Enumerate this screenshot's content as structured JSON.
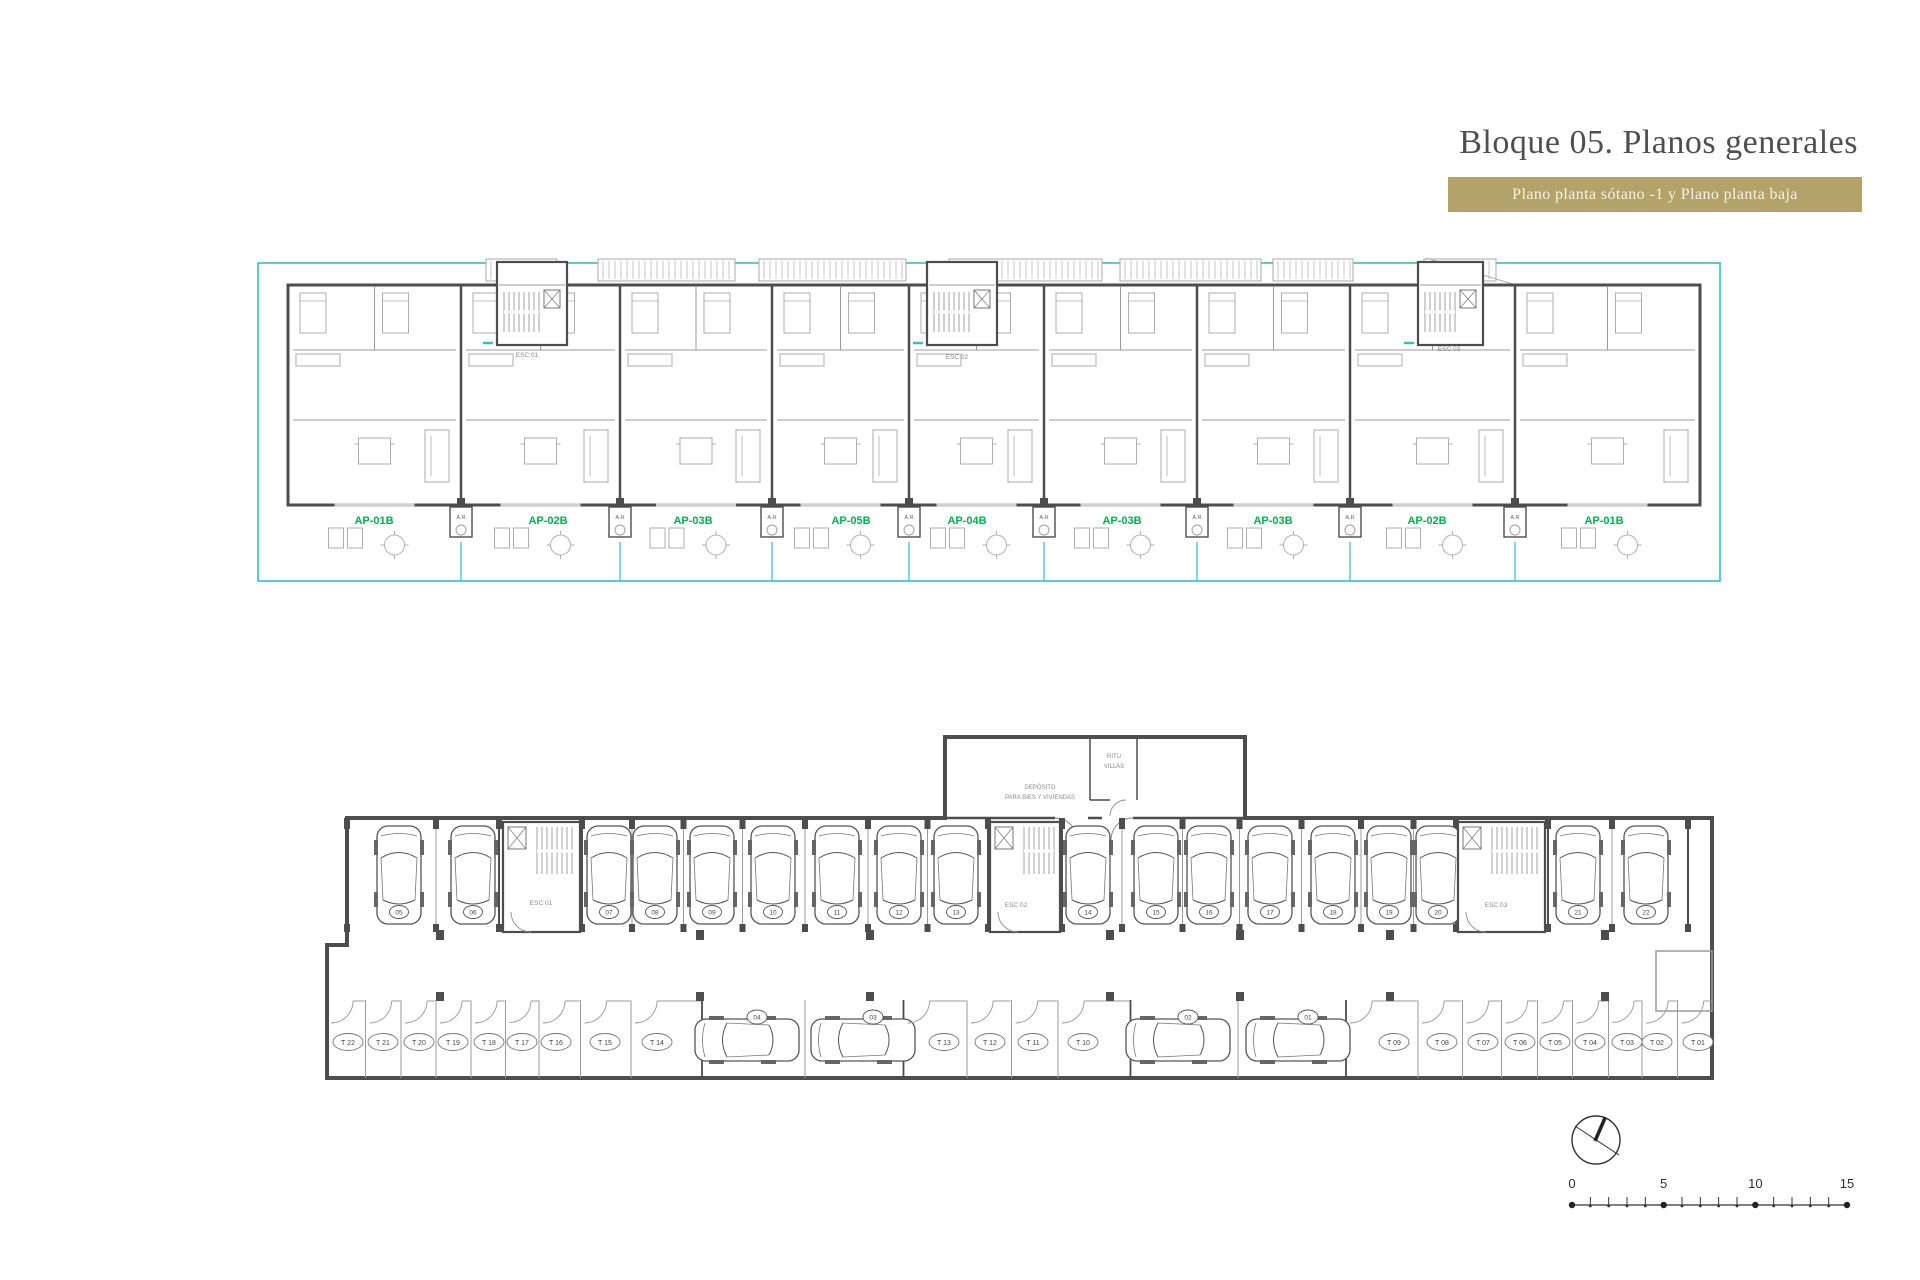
{
  "header": {
    "title": "Bloque 05. Planos generales",
    "subtitle": "Plano planta sótano -1 y Plano planta baja"
  },
  "colors": {
    "band": "#b3a369",
    "title_text": "#4f4f4f",
    "wall": "#4d4d4d",
    "light_wall": "#9b9b9b",
    "furniture": "#aeaeae",
    "boundary_cyan": "#2fc2c6",
    "unit_green": "#00b24f",
    "small_text": "#8a8a8a",
    "scale_text": "#2e2e2e"
  },
  "icons": {
    "compass": "north-arrow-icon"
  },
  "upper_plan": {
    "units": [
      {
        "label": "AP-01B",
        "x": 374
      },
      {
        "label": "AP-02B",
        "x": 548
      },
      {
        "label": "AP-03B",
        "x": 693
      },
      {
        "label": "AP-05B",
        "x": 851
      },
      {
        "label": "AP-04B",
        "x": 967
      },
      {
        "label": "AP-03B",
        "x": 1122
      },
      {
        "label": "AP-03B",
        "x": 1273
      },
      {
        "label": "AP-02B",
        "x": 1427
      },
      {
        "label": "AP-01B",
        "x": 1604
      }
    ],
    "stair_cores": [
      {
        "label": "ESC 01",
        "x1": 497,
        "x2": 567,
        "lx": 527,
        "ly": 357
      },
      {
        "label": "ESC 02",
        "x1": 927,
        "x2": 997,
        "lx": 957,
        "ly": 359
      },
      {
        "label": "ESC 03",
        "x1": 1418,
        "x2": 1483,
        "lx": 1449,
        "ly": 351
      }
    ],
    "utility_label": "A.R"
  },
  "lower_plan": {
    "rooms": [
      {
        "lines": [
          "DEPÓSITO",
          "PARA BIES Y VIVIENDAS"
        ],
        "x": 1040,
        "y": 789
      },
      {
        "lines": [
          "RITU",
          "VILLAS"
        ],
        "x": 1114,
        "y": 758
      }
    ],
    "stair_cores": [
      {
        "label": "ESC 01",
        "x1": 503,
        "x2": 580,
        "lx": 541,
        "ly": 905
      },
      {
        "label": "ESC 02",
        "x1": 990,
        "x2": 1060,
        "lx": 1016,
        "ly": 907
      },
      {
        "label": "ESC 03",
        "x1": 1458,
        "x2": 1545,
        "lx": 1496,
        "ly": 907
      }
    ],
    "top_row_groups": [
      {
        "x1": 347,
        "x2": 499,
        "cars": [
          {
            "num": "05",
            "x": 399
          },
          {
            "num": "06",
            "x": 473
          }
        ]
      },
      {
        "x1": 582,
        "x2": 988,
        "cars": [
          {
            "num": "07",
            "x": 609
          },
          {
            "num": "08",
            "x": 655
          },
          {
            "num": "09",
            "x": 712
          },
          {
            "num": "10",
            "x": 773
          },
          {
            "num": "11",
            "x": 837
          },
          {
            "num": "12",
            "x": 899
          },
          {
            "num": "13",
            "x": 956
          }
        ]
      },
      {
        "x1": 1062,
        "x2": 1456,
        "cars": [
          {
            "num": "14",
            "x": 1088
          },
          {
            "num": "15",
            "x": 1156
          },
          {
            "num": "16",
            "x": 1209
          },
          {
            "num": "17",
            "x": 1270
          },
          {
            "num": "18",
            "x": 1333
          },
          {
            "num": "19",
            "x": 1389
          },
          {
            "num": "20",
            "x": 1438
          }
        ]
      },
      {
        "x1": 1548,
        "x2": 1688,
        "cars": [
          {
            "num": "21",
            "x": 1578
          },
          {
            "num": "22",
            "x": 1646
          }
        ]
      }
    ],
    "bottom_row": [
      {
        "kind": "storage",
        "label": "T 22",
        "x": 348
      },
      {
        "kind": "storage",
        "label": "T 21",
        "x": 383
      },
      {
        "kind": "storage",
        "label": "T 20",
        "x": 419
      },
      {
        "kind": "storage",
        "label": "T 19",
        "x": 453
      },
      {
        "kind": "storage",
        "label": "T 18",
        "x": 489
      },
      {
        "kind": "storage",
        "label": "T 17",
        "x": 522
      },
      {
        "kind": "storage",
        "label": "T 16",
        "x": 556
      },
      {
        "kind": "storage",
        "label": "T 15",
        "x": 605
      },
      {
        "kind": "storage",
        "label": "T 14",
        "x": 657
      },
      {
        "kind": "car",
        "label": "04",
        "x": 747
      },
      {
        "kind": "car",
        "label": "03",
        "x": 863
      },
      {
        "kind": "storage",
        "label": "T 13",
        "x": 944
      },
      {
        "kind": "storage",
        "label": "T 12",
        "x": 990
      },
      {
        "kind": "storage",
        "label": "T 11",
        "x": 1033
      },
      {
        "kind": "storage",
        "label": "T 10",
        "x": 1083
      },
      {
        "kind": "car",
        "label": "02",
        "x": 1178
      },
      {
        "kind": "car",
        "label": "01",
        "x": 1298
      },
      {
        "kind": "storage",
        "label": "T 09",
        "x": 1394
      },
      {
        "kind": "storage",
        "label": "T 08",
        "x": 1442
      },
      {
        "kind": "storage",
        "label": "T 07",
        "x": 1483
      },
      {
        "kind": "storage",
        "label": "T 06",
        "x": 1520
      },
      {
        "kind": "storage",
        "label": "T 05",
        "x": 1555
      },
      {
        "kind": "storage",
        "label": "T 04",
        "x": 1590
      },
      {
        "kind": "storage",
        "label": "T 03",
        "x": 1627
      },
      {
        "kind": "storage",
        "label": "T 02",
        "x": 1657
      },
      {
        "kind": "storage",
        "label": "T 01",
        "x": 1698
      }
    ]
  },
  "scale_bar": {
    "labels": [
      "0",
      "5",
      "10",
      "15"
    ]
  }
}
